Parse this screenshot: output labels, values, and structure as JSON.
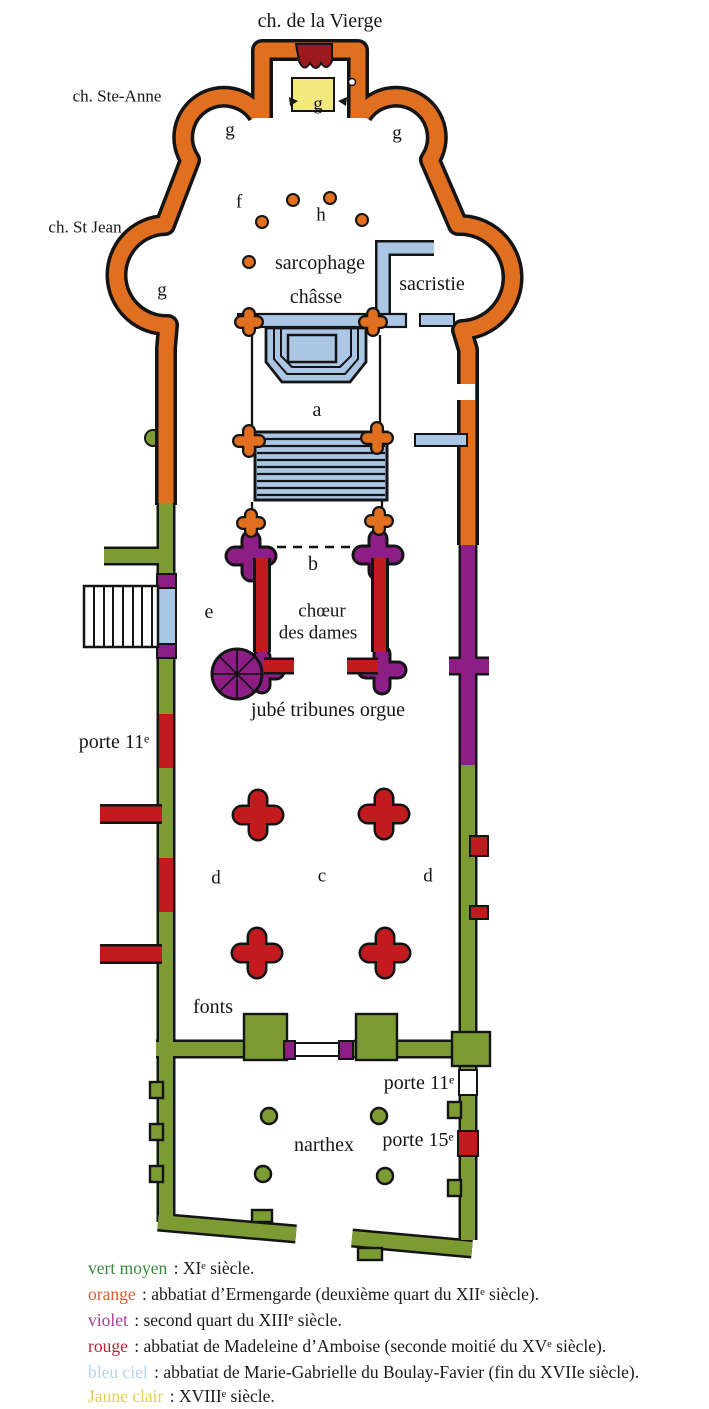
{
  "plan": {
    "labels": [
      {
        "id": "chapel-vierge-label",
        "text": "ch. de la Vierge"
      },
      {
        "id": "chapel-ste-anne-label",
        "text": "ch. Ste-Anne"
      },
      {
        "id": "chapel-st-jean-label",
        "text": "ch. St Jean"
      },
      {
        "id": "g-center",
        "text": "g"
      },
      {
        "id": "g-left",
        "text": "g"
      },
      {
        "id": "g-right",
        "text": "g"
      },
      {
        "id": "f",
        "text": "f"
      },
      {
        "id": "h",
        "text": "h"
      },
      {
        "id": "sarcophage",
        "text": "sarcophage"
      },
      {
        "id": "chasse",
        "text": "châsse"
      },
      {
        "id": "sacristie",
        "text": "sacristie"
      },
      {
        "id": "g-st-jean",
        "text": "g"
      },
      {
        "id": "a",
        "text": "a"
      },
      {
        "id": "b",
        "text": "b"
      },
      {
        "id": "e",
        "text": "e"
      },
      {
        "id": "choeur",
        "text": "chœur"
      },
      {
        "id": "des-dames",
        "text": "des dames"
      },
      {
        "id": "jube",
        "text": "jubé tribunes orgue"
      },
      {
        "id": "porte-11-nave",
        "text": "porte 11ᵉ"
      },
      {
        "id": "d-left",
        "text": "d"
      },
      {
        "id": "c",
        "text": "c"
      },
      {
        "id": "d-right",
        "text": "d"
      },
      {
        "id": "fonts",
        "text": "fonts"
      },
      {
        "id": "porte-11-narthex",
        "text": "porte 11ᵉ"
      },
      {
        "id": "narthex",
        "text": "narthex"
      },
      {
        "id": "porte-15",
        "text": "porte 15ᵉ"
      }
    ]
  },
  "legend": {
    "items": [
      {
        "name": "vert moyen",
        "color": "#3b8a3b",
        "rest": " : XIᵉ siècle."
      },
      {
        "name": "orange",
        "color": "#e05a2b",
        "rest": " : abbatiat d’Ermengarde (deuxième quart du XIIᵉ siècle)."
      },
      {
        "name": "violet",
        "color": "#a63a9a",
        "rest": " : second quart du XIIIᵉ siècle."
      },
      {
        "name": "rouge",
        "color": "#c62038",
        "rest": " : abbatiat de Madeleine d’Amboise (seconde moitié du XVᵉ siècle)."
      },
      {
        "name": "bleu ciel",
        "color": "#b7d3ea",
        "rest": " : abbatiat de Marie-Gabrielle du Boulay-Favier (fin du XVIIe siècle)."
      },
      {
        "name": "Jaune clair",
        "color": "#e4cf49",
        "rest": " : XVIIIᵉ siècle."
      }
    ]
  },
  "colors": {
    "wall_11e_green": "#7c9b33",
    "wall_12e_orange": "#e0701f",
    "wall_13e_violet": "#8c1e86",
    "wall_15e_red": "#c11b20",
    "wall_17e_blue": "#abc7e5",
    "wall_18e_yellow": "#f3e87d",
    "altar_darkred": "#9c1a1d",
    "outline": "#141414"
  }
}
